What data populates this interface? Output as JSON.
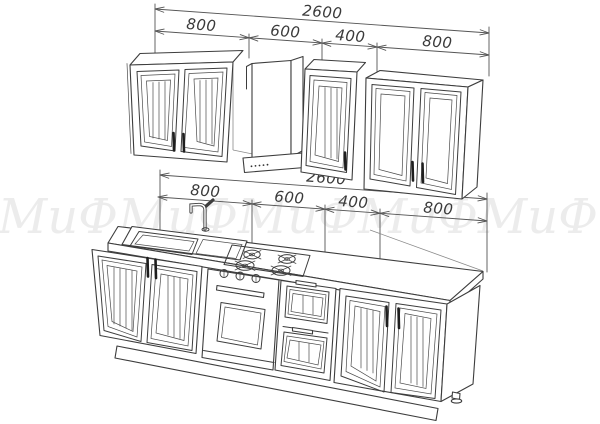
{
  "watermark": {
    "text": "МиФ",
    "color": "#ececec"
  },
  "dimensions": {
    "top": {
      "overall": "2600",
      "segments": [
        "800",
        "600",
        "400",
        "800"
      ]
    },
    "middle": {
      "overall": "2600",
      "segments": [
        "800",
        "600",
        "400",
        "800"
      ]
    }
  },
  "style": {
    "line_color": "#3d3d3d",
    "dimension_color": "#3a3a3a",
    "watermark_color": "#ececec",
    "background": "#ffffff"
  }
}
